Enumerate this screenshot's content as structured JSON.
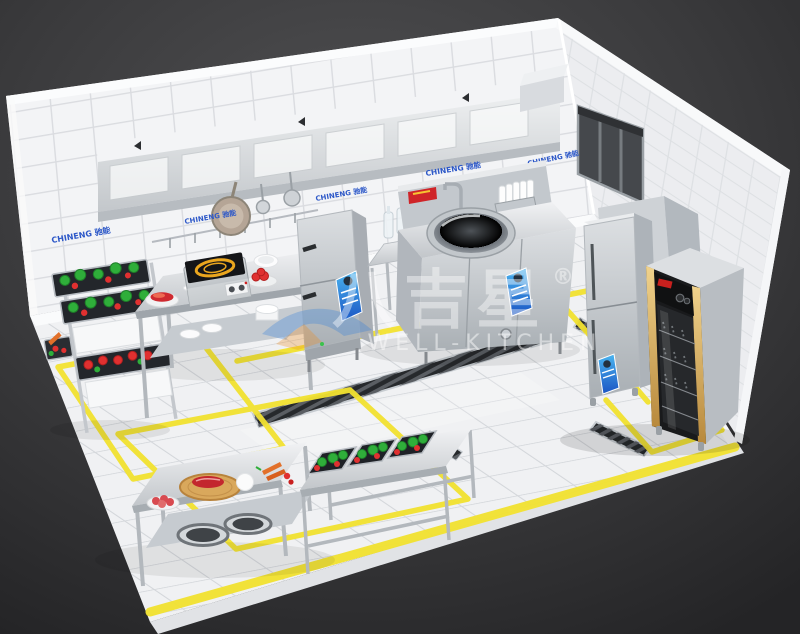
{
  "scene": {
    "description": "3D isometric rendering of a commercial kitchen",
    "watermark": {
      "brand_cn": "八吉星",
      "registered": "®",
      "brand_en": "WELL-KITCHEN"
    },
    "brand": {
      "wall_label_full": "CHINENG 驰能"
    },
    "colors": {
      "background": "#3a3a3c",
      "wall_tile": "#f3f4f6",
      "floor": "#eff0f2",
      "stainless_steel": "#c9cdd2",
      "safety_yellow": "#f2e230",
      "banner_blue": "#2f7fd9",
      "cabinet_gold": "#d9b469",
      "vegetable_green": "#2fae3a",
      "vegetable_red": "#e03030",
      "cutting_board_wood": "#d9a85c"
    }
  }
}
